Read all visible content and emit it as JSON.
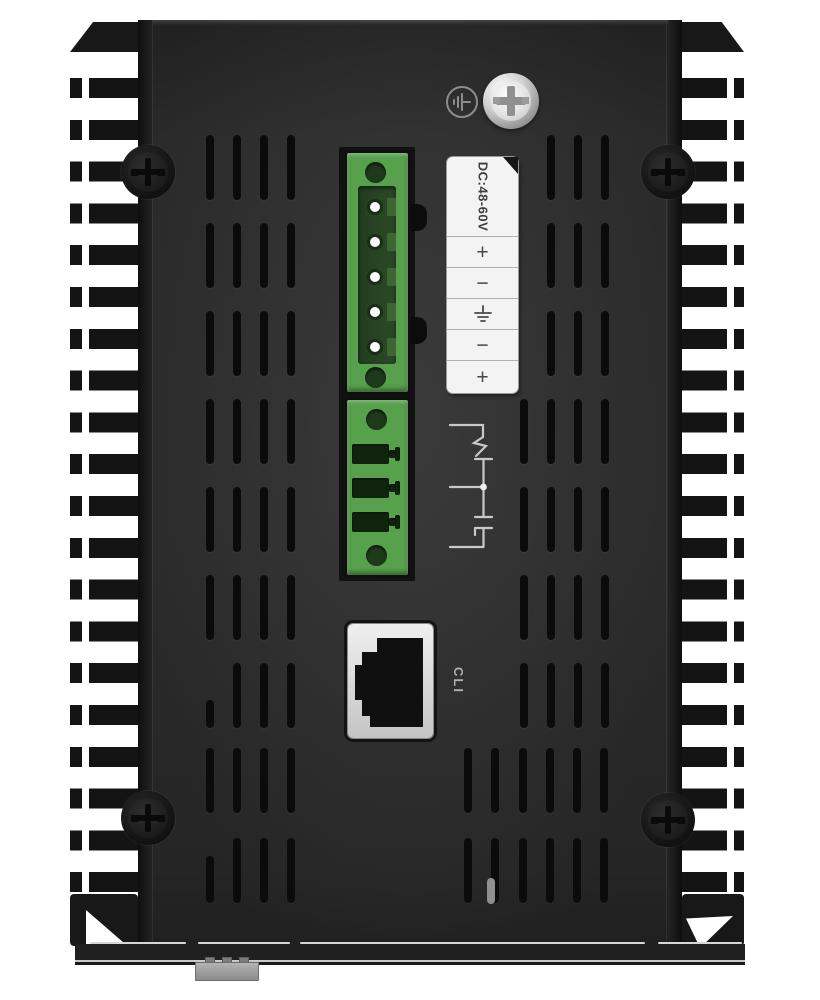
{
  "power": {
    "rating_label": "DC:48-60V",
    "terminal_markings": [
      "+",
      "−",
      "⏚",
      "−",
      "+"
    ]
  },
  "console": {
    "port_label": "CLI"
  },
  "colors": {
    "connector_green": "#57a04c",
    "connector_recess_green": "#2c4a27",
    "label_white": "#f3f3f3",
    "panel_gray": "#2e2e2e",
    "chassis_black": "#161616",
    "screw_silver": "#d9d9d9",
    "diagram_line_gray": "#c9c9c9"
  },
  "icons": {
    "grounding_symbol": "earth-ground",
    "terminal_earth_symbol": "earth-ground",
    "screw_heads": "phillips-cross",
    "relay_contact_symbol": "changeover-contact-diagram"
  }
}
